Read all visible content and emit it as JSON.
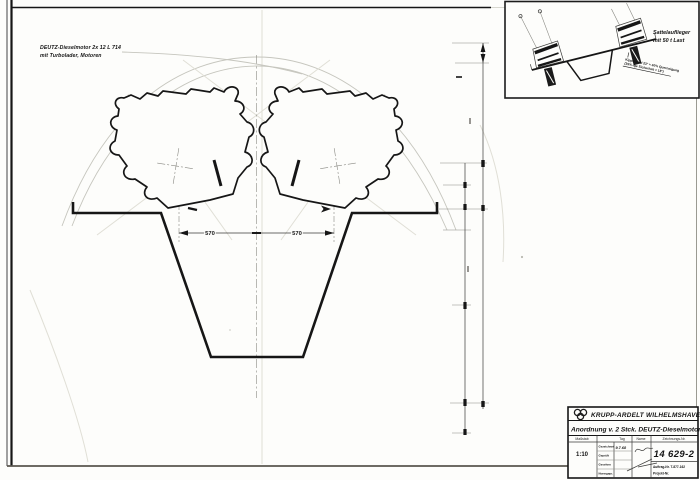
{
  "colors": {
    "ink": "#161616",
    "faint_line": "#c6c6be",
    "paper": "#fdfdfb"
  },
  "note": {
    "line1": "DEUTZ-Dieselmotor  2x 12 L 714",
    "line2": "mit Turbolader, Motoren"
  },
  "inset": {
    "caption_line1": "Sattelauflieger",
    "caption_line2": "mit  50 t  Last",
    "note_line1": "Kippwinkel 23° ≈ 40% Querneigung",
    "note_line2": "(35%-ige Sicherheit ≈ 18°)"
  },
  "dims": {
    "between_centers_left": "570",
    "between_centers_right": "570"
  },
  "title_block": {
    "company": "KRUPP-ARDELT  WILHELMSHAVEN",
    "title": "Anordnung v. 2 Stck.  DEUTZ-Dieselmotoren",
    "scale_label": "Maßstab",
    "scale_value": "1:10",
    "tag_label": "Tag",
    "name_label": "Name",
    "drawing_no_label": "Zeichnungs-Nr.",
    "drawing_no": "14  629-2",
    "date": "9.7.68",
    "rows": [
      "Gezeichnet",
      "Geprüft",
      "Gesehen",
      "Normgepr."
    ],
    "order_no": "Auftrag-Nr.  T-877-162",
    "project_no": "Projekt-Nr."
  }
}
